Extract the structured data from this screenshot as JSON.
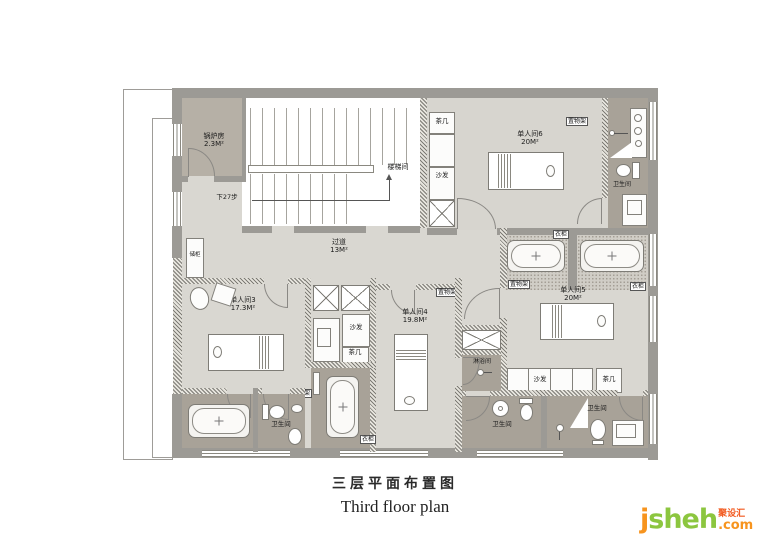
{
  "title": {
    "zh": "三层平面布置图",
    "en": "Third floor plan"
  },
  "logo": {
    "j": "j",
    "name": "sheh",
    "suffix": ".com",
    "zh": "聚设汇"
  },
  "rooms": {
    "boiler": {
      "name": "锅炉房",
      "area": "2.3M²"
    },
    "stairwell": {
      "name": "楼梯间"
    },
    "stairs_note": "下27步",
    "corridor": {
      "name": "过道",
      "area": "13M²"
    },
    "room3": {
      "name": "单人间3",
      "area": "17.3M²"
    },
    "room4": {
      "name": "单人间4",
      "area": "19.8M²"
    },
    "room5": {
      "name": "单人间5",
      "area": "20M²"
    },
    "room6": {
      "name": "单人间6",
      "area": "20M²"
    },
    "bathroom": "卫生间",
    "shower_room": "淋浴间"
  },
  "furniture": {
    "tea_table": "茶几",
    "sofa": "沙发",
    "shelf": "置物架",
    "wardrobe": "衣柜",
    "cabinet": "储柜"
  },
  "colors": {
    "wall": "#9c9a95",
    "room_floor": "#d7d5cf",
    "bath_floor": "#a8a298",
    "boiler_floor": "#b6b0a6",
    "logo_orange": "#f7941e",
    "logo_green": "#8cc63f",
    "logo_red": "#f2591e"
  }
}
